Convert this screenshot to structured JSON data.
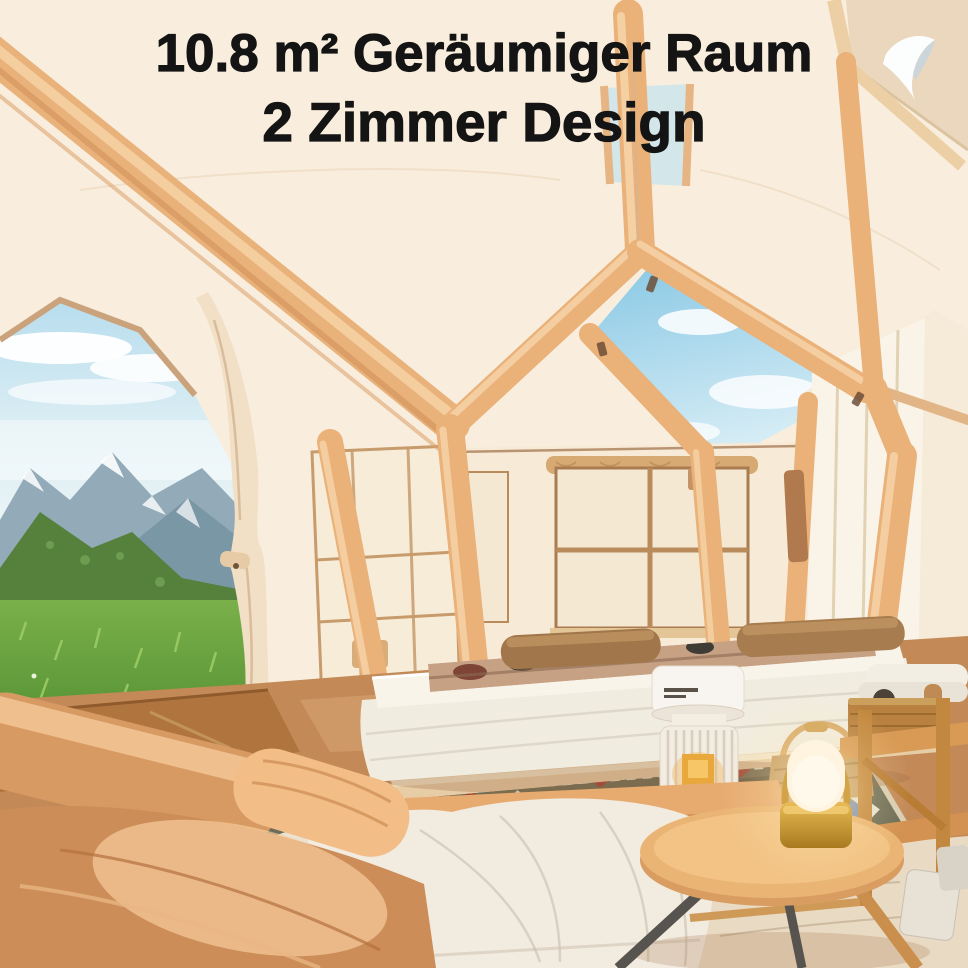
{
  "meta": {
    "image_kind": "product lifestyle photo",
    "subject": "interior of an inflatable 2-room glamping tent with mountain view"
  },
  "headline": {
    "line1": "10.8 m² Geräumiger Raum",
    "line2": "2 Zimmer Design"
  },
  "branding": {
    "logo": "white-dove-mark"
  },
  "palette": {
    "headline_black": "#141414",
    "tent_cream": "#f9eedd",
    "beam_tan": "#eab179",
    "floor_brown": "#c38a58",
    "sofa_tan": "#d7955f",
    "sky_blue": "#9fd2e9",
    "grass_green": "#5c9639",
    "rug_olive": "#6d6d57",
    "lamp_glow": "#ffe4aa",
    "lamp_gold": "#c9952d"
  },
  "scene_objects": [
    "inflatable-beam-frame",
    "open-roof-skylight",
    "door-mountain-view",
    "tied-back-curtain",
    "left-mesh-window",
    "back-room-window",
    "right-wall-window",
    "air-mattress",
    "brown-pillows",
    "patterned-blanket",
    "portable-heater",
    "aztec-rug",
    "woven-floor-mat",
    "inflatable-sofa",
    "bench-with-white-blanket",
    "round-wood-table",
    "portable-dome-lamp",
    "wood-camp-shelf",
    "wicker-basket",
    "ceramic-vases"
  ]
}
